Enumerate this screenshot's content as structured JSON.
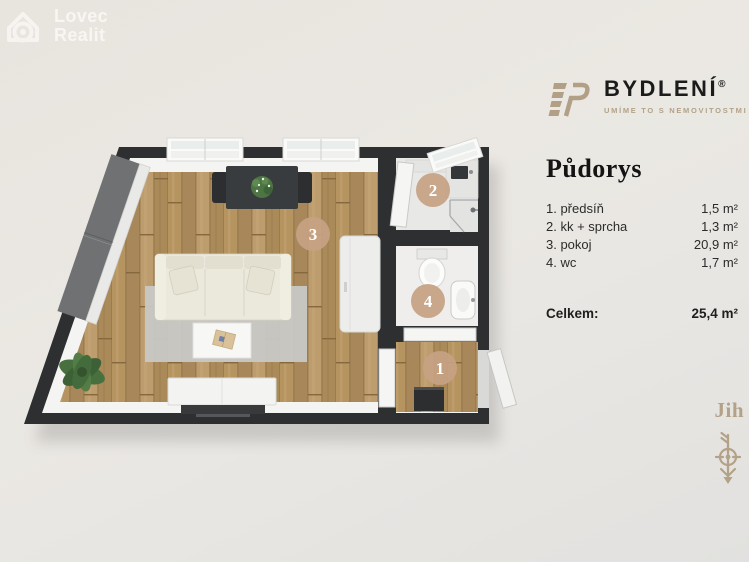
{
  "watermark": {
    "line1": "Lovec",
    "line2": "Realit"
  },
  "brand": {
    "name": "BYDLENÍ",
    "registered": "®",
    "tagline": "UMÍME TO S NEMOVITOSTMI",
    "accent_color": "#b3a288"
  },
  "panel": {
    "title": "Půdorys",
    "rooms": [
      {
        "num": "1",
        "label": "1. předsíň",
        "area": "1,5 m²"
      },
      {
        "num": "2",
        "label": "2. kk + sprcha",
        "area": "1,3 m²"
      },
      {
        "num": "3",
        "label": "3. pokoj",
        "area": "20,9 m²"
      },
      {
        "num": "4",
        "label": "4. wc",
        "area": "1,7 m²"
      }
    ],
    "total_label": "Celkem:",
    "total_area": "25,4 m²"
  },
  "compass": {
    "label": "Jih"
  },
  "floorplan": {
    "badge_color": "#c6a183",
    "wall_color": "#2e2f31",
    "wood_color": "#b2905f"
  }
}
